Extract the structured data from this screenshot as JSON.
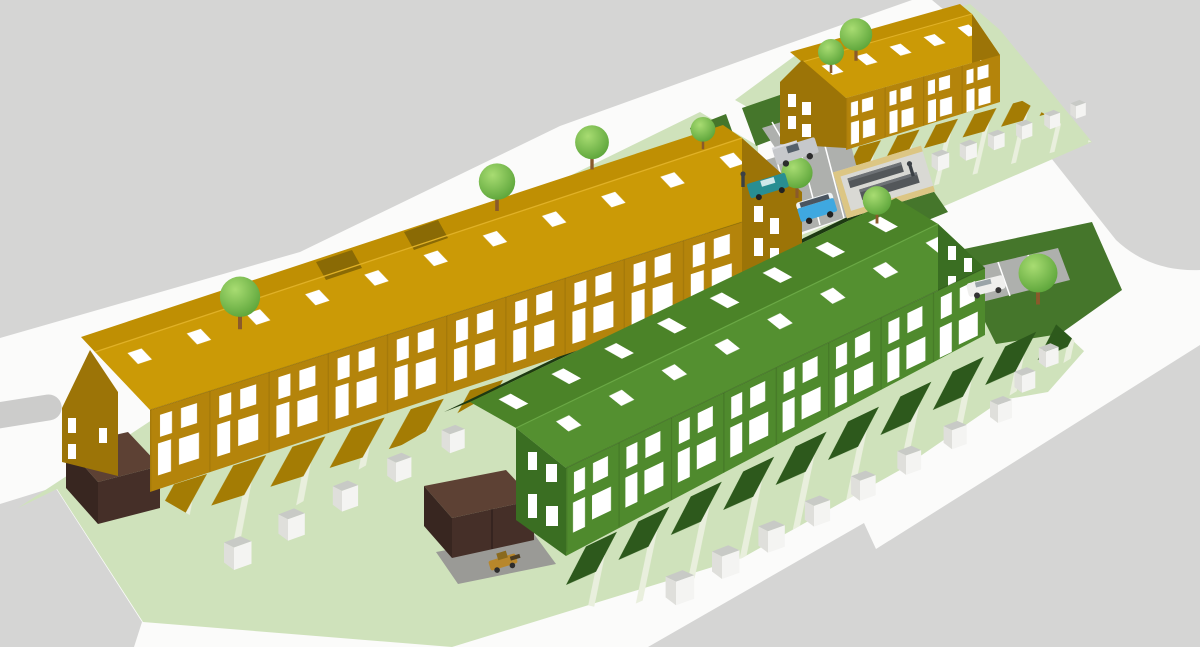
{
  "scene": {
    "kind": "3d-architectural-site-render",
    "description": "Aerial 3D massing render of a housing development: two long terraced rows (ochre and green), a smaller ochre terrace, rear gardens with sheds, parking courts, roads and street trees",
    "no_visible_text": true
  },
  "colors": {
    "road": "#fbfbfa",
    "plane": "#d5d5d4",
    "island": "#cccccb",
    "site_green": "#cfe2bb",
    "path": "#e9efdd",
    "dark_green": "#45762b",
    "ochre_roof": "#cb9a06",
    "ochre_roof_nw": "#bf8f03",
    "ochre_wall": "#b4840b",
    "ochre_end": "#9c7407",
    "ochre_shadow": "#a47c04",
    "dormer": "#8a6a05",
    "green_roof_nw": "#4b8328",
    "green_roof_se": "#549030",
    "green_wall": "#4f8a2d",
    "green_end": "#3a6e22",
    "green_shadow": "#2d591c",
    "green_eave_dark": "#1d3a12",
    "shed_front": "#f4f4f2",
    "shed_side": "#dfdfdb",
    "shed_top": "#c8cac6",
    "garage_top": "#5d4134",
    "garage_front": "#452f28",
    "garage_side": "#382620",
    "parking": "#aeb0ad",
    "driveway": "#9a9a96",
    "window": "#ffffff",
    "tree_light": "#a8dc72",
    "tree_dark": "#5aa338",
    "trunk": "#8a5a2b",
    "tan_wall": "#dcc684",
    "bin_dark": "#53575a",
    "bin_top": "#6e7276",
    "figure": "#3b4045"
  },
  "buildings": [
    {
      "id": "west-terrace",
      "label": "long ochre terrace",
      "units": 10,
      "storeys": 2,
      "rear_sheds": 5,
      "garage_blocks": 2
    },
    {
      "id": "east-terrace",
      "label": "green terrace",
      "units": 8,
      "storeys": 2,
      "rear_sheds": 10,
      "garage_blocks": 0
    },
    {
      "id": "north-terrace",
      "label": "small ochre terrace",
      "units": 4,
      "storeys": 2,
      "rear_sheds": 6,
      "garage_blocks": 0
    }
  ],
  "site": {
    "trees": 9,
    "garden_sheds_total": 21,
    "bin_store_enclosures": 1,
    "parking_areas": 4,
    "people": 2
  },
  "vehicles": [
    {
      "name": "grey-van",
      "color": "#c6c8cb"
    },
    {
      "name": "teal-pickup",
      "color": "#288e92"
    },
    {
      "name": "blue-campervan",
      "color": "#3fa8e0",
      "roof": "#eef3f5"
    },
    {
      "name": "white-car",
      "color": "#efefed"
    },
    {
      "name": "yellow-digger",
      "color": "#b8872b"
    }
  ]
}
